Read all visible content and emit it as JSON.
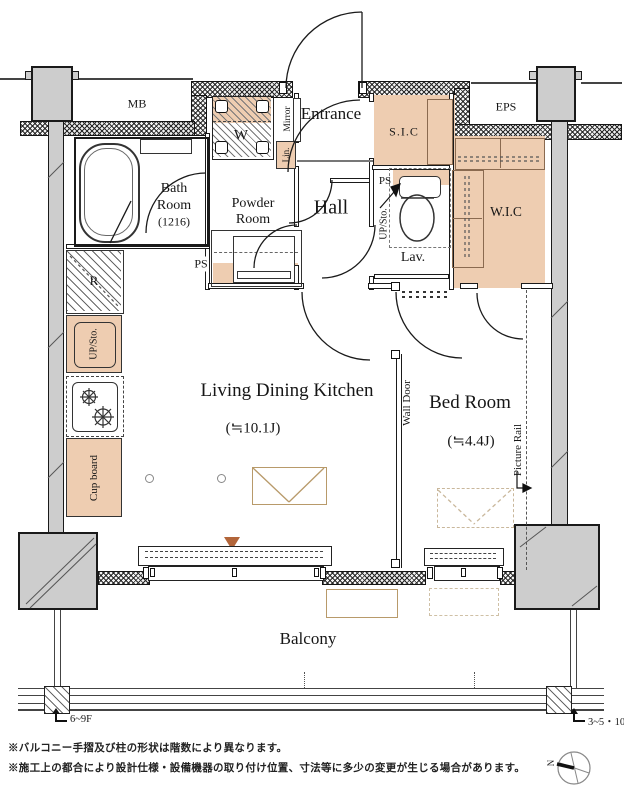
{
  "plan_title": "1K apartment floor plan",
  "colors": {
    "tan": "#eecdb1",
    "tan_border": "#8a6a50",
    "column_gray": "#cdcdcd",
    "wall": "#1a1a1a",
    "furniture_line": "#b89a6a",
    "accent_triangle": "#b2653a"
  },
  "rooms": {
    "mb": "MB",
    "eps": "EPS",
    "entrance": "Entrance",
    "sic": "S.I.C",
    "wic": "W.I.C",
    "bath_l1": "Bath",
    "bath_l2": "Room",
    "bath_l3": "(1216)",
    "powder_l1": "Powder",
    "powder_l2": "Room",
    "hall": "Hall",
    "lav": "Lav.",
    "washer": "W",
    "ldk_name": "Living Dining Kitchen",
    "ldk_size": "(≒10.1J)",
    "bedroom_name": "Bed Room",
    "bedroom_size": "(≒4.4J)",
    "balcony": "Balcony"
  },
  "labels": {
    "mirror": "Mirror",
    "linen": "Lin.",
    "ps_powder": "PS",
    "ps_lav": "PS",
    "up_sto_lav": "UP/Sto.",
    "up_sto_kitchen": "UP/Sto.",
    "cupboard": "Cup board",
    "fridge": "R",
    "wall_door": "Wall Door",
    "picture_rail": "Picture Rail",
    "floor_left": "6~9F",
    "floor_right": "3~5・10F",
    "north": "N"
  },
  "footnotes": [
    "※バルコニー手摺及び柱の形状は階数により異なります。",
    "※施工上の都合により設計仕様・設備機器の取り付け位置、寸法等に多少の変更が生じる場合があります。"
  ]
}
